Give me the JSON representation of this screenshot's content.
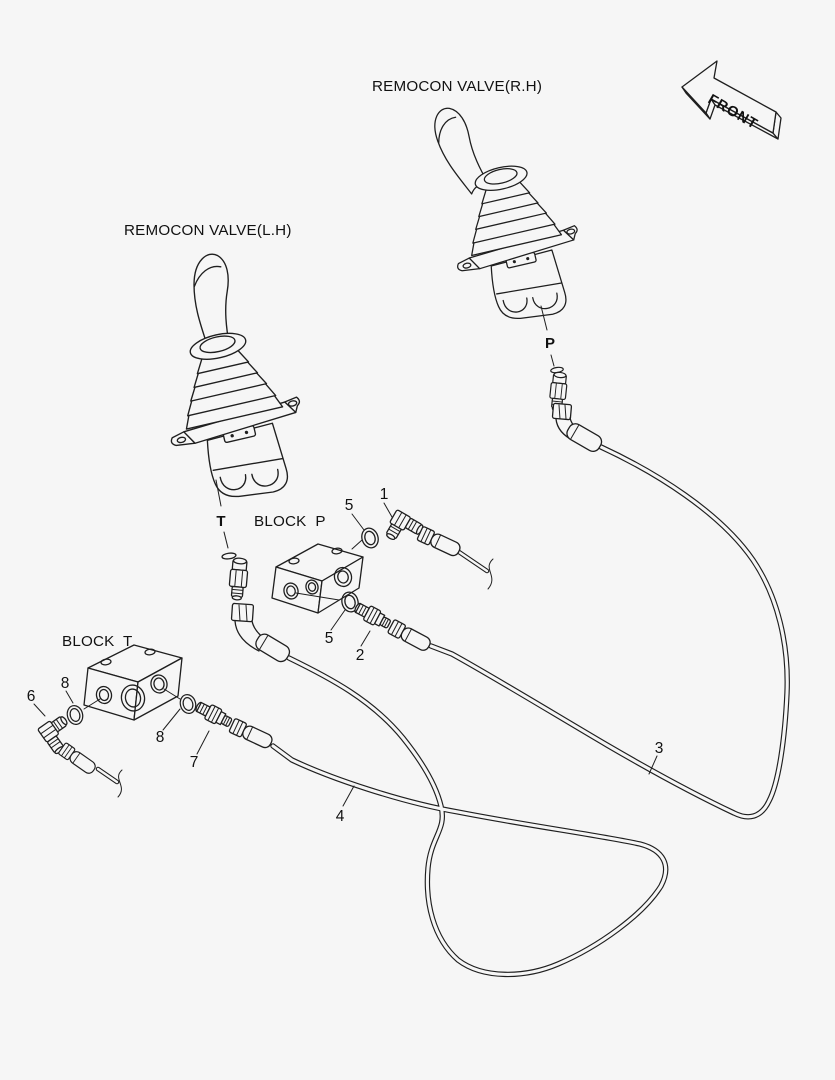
{
  "diagram": {
    "background": "#f6f6f6",
    "line_color": "#1f1f1f",
    "labels": {
      "valve_rh": "REMOCON VALVE(R.H)",
      "valve_lh": "REMOCON VALVE(L.H)",
      "block_p": "BLOCK  P",
      "block_t": "BLOCK  T",
      "front": "FRONT",
      "port_t": "T",
      "port_p": "P"
    },
    "callouts": [
      {
        "num": "1"
      },
      {
        "num": "5"
      },
      {
        "num": "5"
      },
      {
        "num": "2"
      },
      {
        "num": "3"
      },
      {
        "num": "4"
      },
      {
        "num": "6"
      },
      {
        "num": "7"
      },
      {
        "num": "8"
      },
      {
        "num": "8"
      }
    ]
  }
}
